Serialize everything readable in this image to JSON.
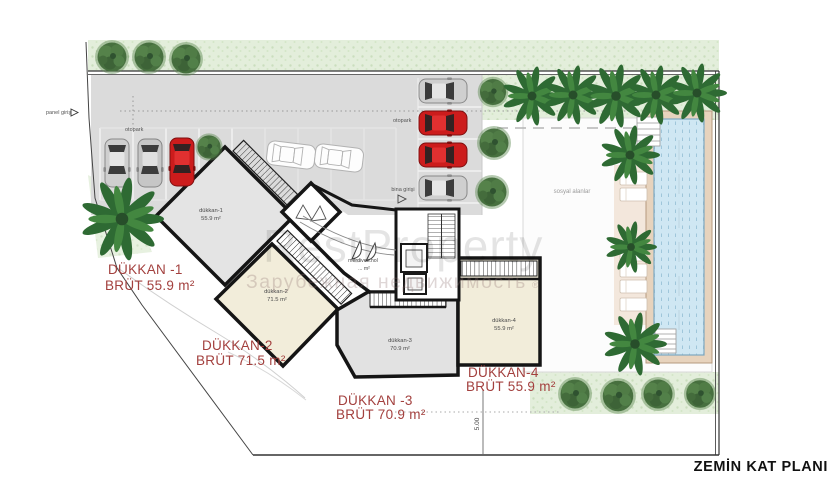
{
  "title": "ZEMİN KAT PLANI",
  "watermark": {
    "brand": "RestProperty",
    "registered": "®",
    "subtitle": "Зарубежная недвижимость"
  },
  "site_labels": {
    "panel_entrance": "panel giriş",
    "parking_left": "otopark",
    "parking_right": "otopark",
    "building_entrance": "bina girişi",
    "social_areas": "sosyal alanlar",
    "dimension": "5.00"
  },
  "rooms": [
    {
      "id": "dukkan-1",
      "label": "dükkan-1",
      "area": "55.9 m²"
    },
    {
      "id": "dukkan-2",
      "label": "dükkan-2",
      "area": "71.5 m²"
    },
    {
      "id": "dukkan-3",
      "label": "dükkan-3",
      "area": "70.9 m²"
    },
    {
      "id": "dukkan-4",
      "label": "dükkan-4",
      "area": "55.9 m²"
    },
    {
      "id": "merdiven-hol",
      "label": "merdiven.hol",
      "area": "... m²"
    }
  ],
  "shop_annotations": [
    {
      "line1": "DÜKKAN -1",
      "line2": "BRÜT 55.9 m²"
    },
    {
      "line1": "DÜKKAN-2",
      "line2": "BRÜT 71.5 m²"
    },
    {
      "line1": "DÜKKAN -3",
      "line2": "BRÜT 70.9 m²"
    },
    {
      "line1": "DÜKKAN-4",
      "line2": "BRÜT 55.9 m²"
    }
  ],
  "colors": {
    "annotation_red": "#a3403e",
    "car_red": "#cc1c1c",
    "car_silver": "#cfcfcf",
    "road_gray": "#dbdbdb",
    "room_gray": "#e4e4e4",
    "room_cream": "#f2edda",
    "green_strip": "#e3eedb",
    "tree_green": "#47703f",
    "pool_water": "#cfe7f3",
    "pool_deck": "#e7d3bd",
    "wall_black": "#151515"
  }
}
